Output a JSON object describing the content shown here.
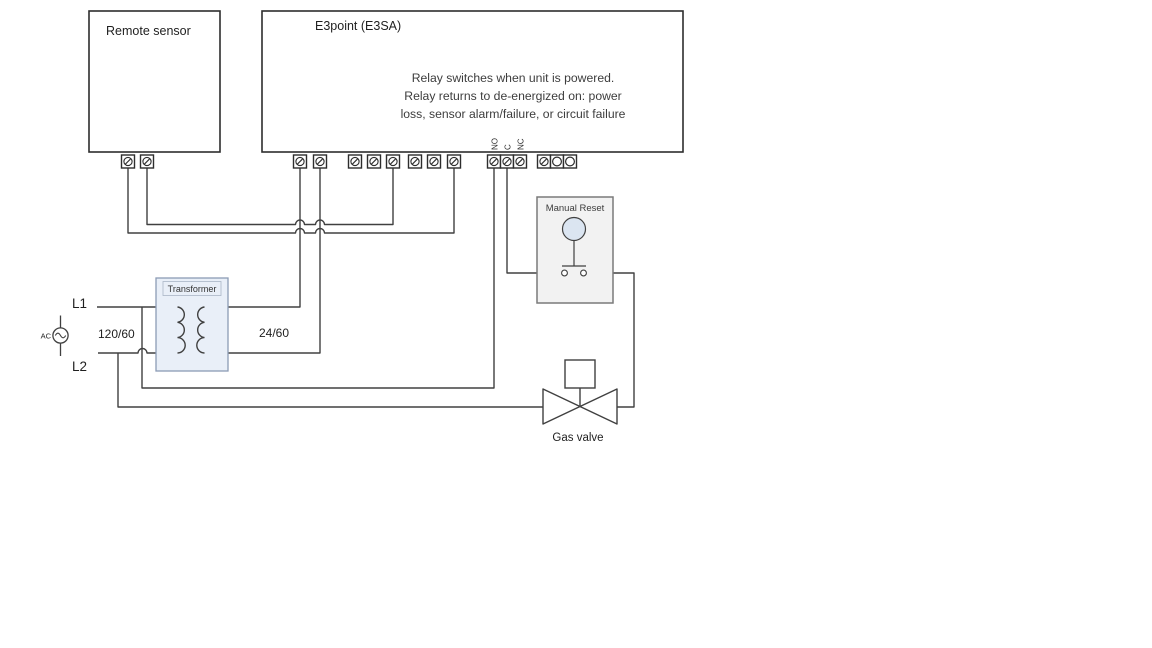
{
  "diagram": {
    "remote_sensor": {
      "title": "Remote sensor"
    },
    "e3point": {
      "title": "E3point (E3SA)",
      "note_line1": "Relay switches when unit is powered.",
      "note_line2": "Relay returns to de-energized on: power",
      "note_line3": "loss, sensor alarm/failure, or circuit failure",
      "relay_terminal_no": "NO",
      "relay_terminal_c": "C",
      "relay_terminal_nc": "NC"
    },
    "manual_reset": {
      "title": "Manual Reset"
    },
    "transformer": {
      "title": "Transformer",
      "primary_rating": "120/60",
      "secondary_rating": "24/60"
    },
    "power": {
      "l1": "L1",
      "l2": "L2",
      "ac": "AC"
    },
    "gas_valve": {
      "label": "Gas valve"
    },
    "colors": {
      "wire": "#404040",
      "box_border": "#2d2d2d",
      "transformer_fill": "#e9eff8",
      "transformer_border": "#8c9cb5",
      "manual_reset_fill": "#f2f2f2",
      "manual_reset_border": "#7a7a7a",
      "button_fill": "#dbe5f1",
      "text": "#3d3d3d"
    }
  }
}
